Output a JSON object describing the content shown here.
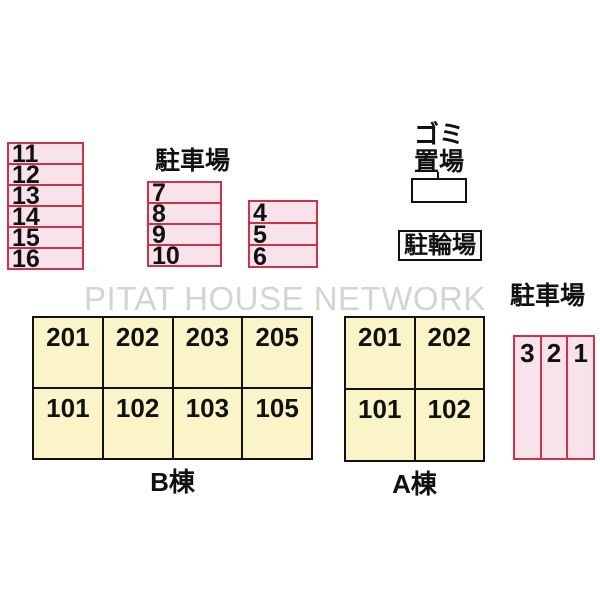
{
  "watermark": "PITAT HOUSE NETWORK",
  "labels": {
    "parking_top": "駐車場",
    "parking_right": "駐車場",
    "garbage_line1": "ゴミ",
    "garbage_line2": "置場",
    "bicycle": "駐輪場"
  },
  "spaces": {
    "left": [
      "11",
      "12",
      "13",
      "14",
      "15",
      "16"
    ],
    "middle": [
      "7",
      "8",
      "9",
      "10"
    ],
    "small": [
      "4",
      "5",
      "6"
    ],
    "right_vertical": [
      "3",
      "2",
      "1"
    ]
  },
  "buildings": {
    "b": {
      "label": "B棟",
      "upper": [
        "201",
        "202",
        "203",
        "205"
      ],
      "lower": [
        "101",
        "102",
        "103",
        "105"
      ]
    },
    "a": {
      "label": "A棟",
      "upper": [
        "201",
        "202"
      ],
      "lower": [
        "101",
        "102"
      ]
    }
  },
  "colors": {
    "space_fill": "#f9e3ea",
    "space_border": "#cc3346",
    "building_fill": "#faf4c8",
    "outline": "#111111",
    "watermark": "#d4d4d4"
  }
}
